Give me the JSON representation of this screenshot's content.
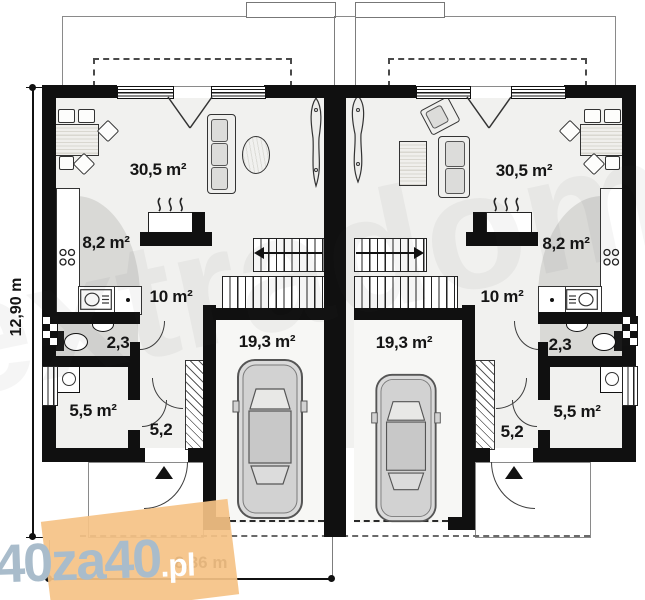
{
  "rooms": {
    "left": {
      "living": "30,5 m²",
      "kitchen": "8,2 m²",
      "hall": "10 m²",
      "bath": "2,3",
      "utility": "5,5 m²",
      "entry": "5,2",
      "garage": "19,3 m²"
    },
    "right": {
      "living": "30,5 m²",
      "kitchen": "8,2 m²",
      "hall": "10 m²",
      "bath": "2,3",
      "utility": "5,5 m²",
      "entry": "5,2",
      "garage": "19,3 m²"
    }
  },
  "dimensions": {
    "depth": "12,90 m",
    "width": "8,36 m"
  },
  "watermark": {
    "p1": "40",
    "p2": "za40",
    "p3": ".pl",
    "faint": "extradom"
  },
  "colors": {
    "wall": "#101010",
    "floor": "#f1f1ef",
    "shade": "#d9d9d6",
    "orange": "#f5c285",
    "wm_text": "#a9bccb"
  }
}
